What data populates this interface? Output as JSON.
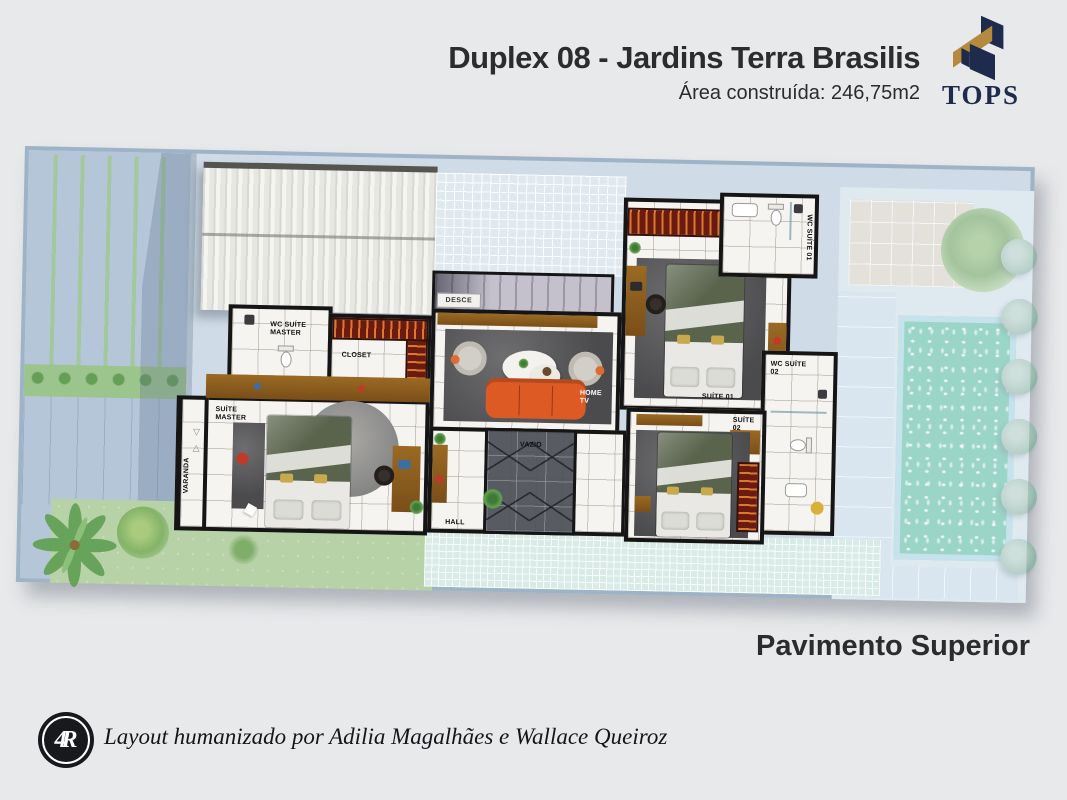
{
  "header": {
    "title": "Duplex 08 - Jardins Terra Brasilis",
    "subtitle": "Área construída: 246,75m2"
  },
  "brand": {
    "name": "TOPS"
  },
  "floor_label": "Pavimento Superior",
  "rooms": {
    "wc_suite_master": "WC SUÍTE\nMASTER",
    "closet": "CLOSET",
    "suite_master": "SUÍTE\nMASTER",
    "varanda": "VARANDA",
    "desce": "DESCE",
    "home_tv": "HOME\nTV",
    "vazio": "VAZIO",
    "hall": "HALL",
    "suite_01": "SUÍTE 01",
    "suite_02": "SUÍTE\n02",
    "wc_suite_01": "WC SUÍTE 01",
    "wc_suite_02": "WC SUÍTE\n02"
  },
  "footer": {
    "monogram": "4R",
    "credit": "Layout humanizado por Adilia Magalhães e Wallace Queiroz"
  },
  "colors": {
    "accent_navy": "#1e2b4d",
    "accent_gold": "#b68a3e",
    "sofa_orange": "#de5a24",
    "pool_teal": "#5ec0a6",
    "wall_black": "#151515"
  }
}
